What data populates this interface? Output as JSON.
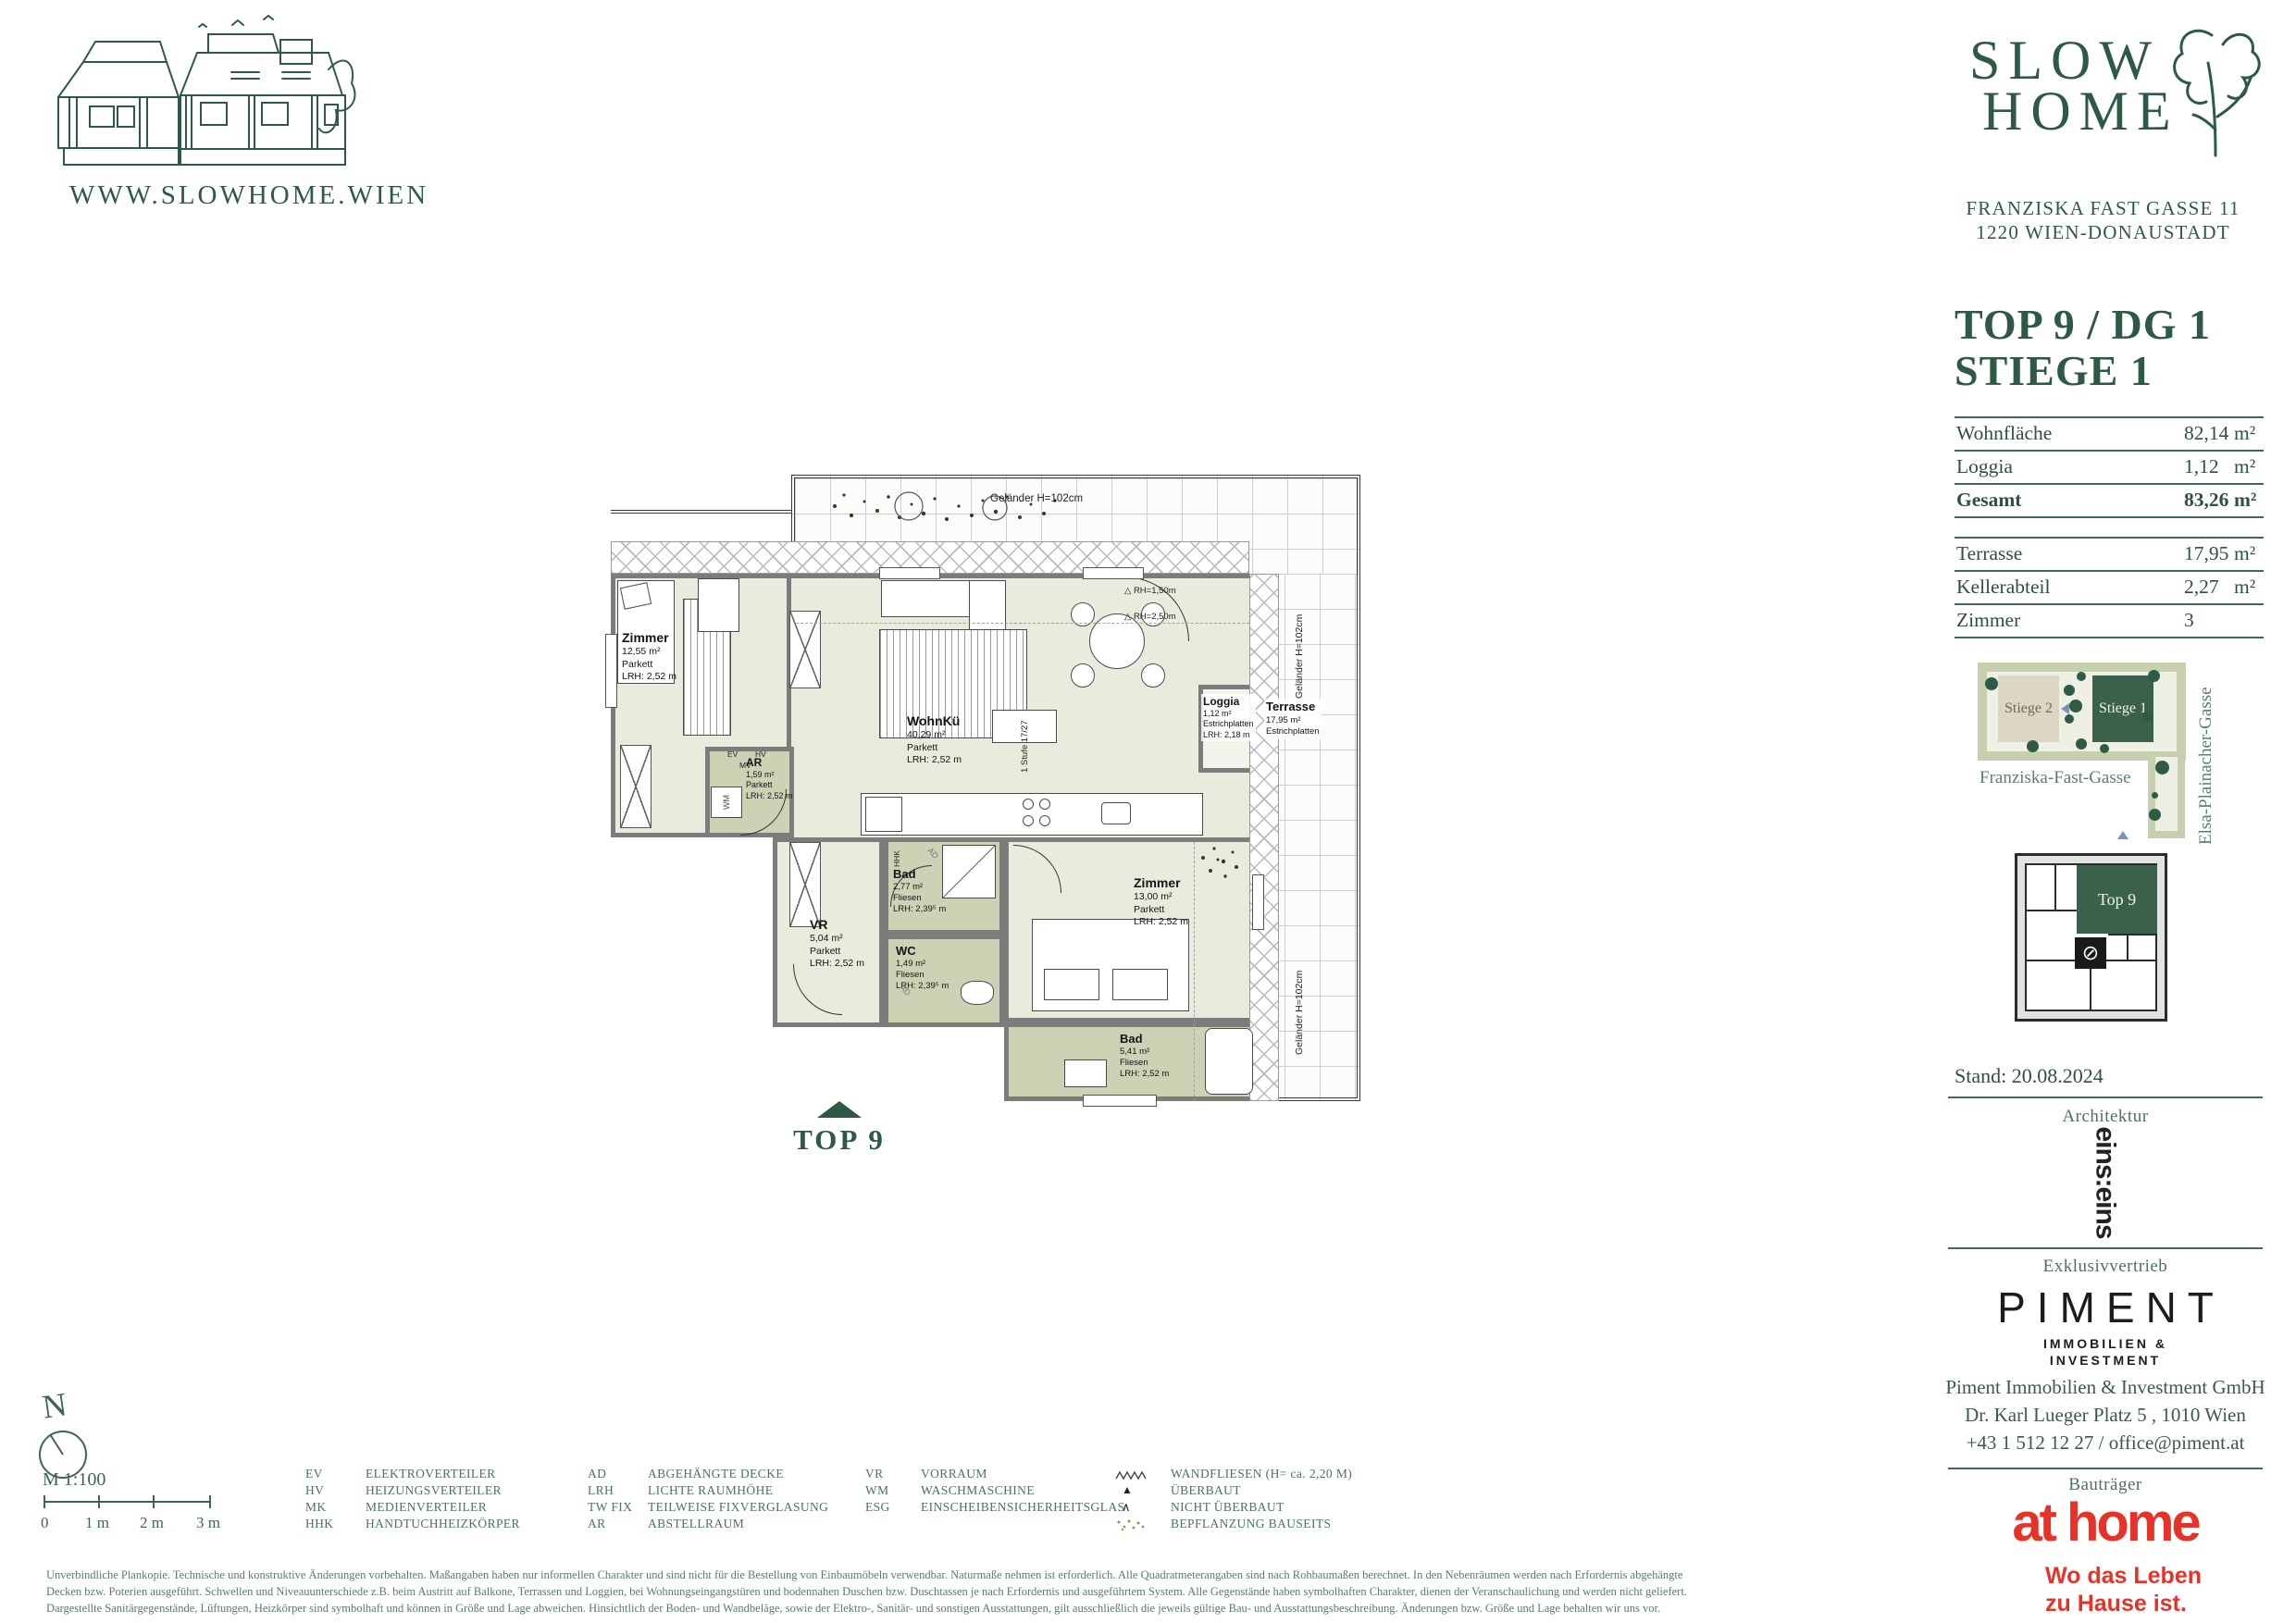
{
  "brand": {
    "website": "WWW.SLOWHOME.WIEN",
    "name_line1": "SLOW",
    "name_line2": "HOME",
    "address_line1": "FRANZISKA FAST GASSE 11",
    "address_line2": "1220 WIEN-DONAUSTADT"
  },
  "unit": {
    "title_line1": "TOP 9 / DG 1",
    "title_line2": "STIEGE 1",
    "areas": [
      {
        "label": "Wohnfläche",
        "value": "82,14",
        "unit": "m²"
      },
      {
        "label": "Loggia",
        "value": "1,12",
        "unit": "m²"
      },
      {
        "label": "Gesamt",
        "value": "83,26",
        "unit": "m²"
      }
    ],
    "extras": [
      {
        "label": "Terrasse",
        "value": "17,95",
        "unit": "m²"
      },
      {
        "label": "Kellerabteil",
        "value": "2,27",
        "unit": "m²"
      },
      {
        "label": "Zimmer",
        "value": "3",
        "unit": ""
      }
    ]
  },
  "site_plan": {
    "stiege2": "Stiege 2",
    "stiege1": "Stiege 1",
    "street_bottom": "Franziska-Fast-Gasse",
    "street_right": "Elsa-Plainacher-Gasse"
  },
  "key_plan": {
    "unit_label": "Top 9"
  },
  "floor_plan": {
    "rooms": {
      "zimmer1": {
        "name": "Zimmer",
        "area": "12,55 m²",
        "floor": "Parkett",
        "lrh": "LRH: 2,52 m"
      },
      "wohnkue": {
        "name": "WohnKü",
        "area": "40,29 m²",
        "floor": "Parkett",
        "lrh": "LRH: 2,52 m"
      },
      "ar": {
        "name": "AR",
        "area": "1,59 m²",
        "floor": "Parkett",
        "lrh": "LRH: 2,52 m"
      },
      "bad1": {
        "name": "Bad",
        "area": "2,77 m²",
        "floor": "Fliesen",
        "lrh": "LRH: 2,39⁵ m"
      },
      "wc": {
        "name": "WC",
        "area": "1,49 m²",
        "floor": "Fliesen",
        "lrh": "LRH: 2,39⁵ m"
      },
      "vr": {
        "name": "VR",
        "area": "5,04 m²",
        "floor": "Parkett",
        "lrh": "LRH: 2,52 m"
      },
      "zimmer2": {
        "name": "Zimmer",
        "area": "13,00 m²",
        "floor": "Parkett",
        "lrh": "LRH: 2,52 m"
      },
      "bad2": {
        "name": "Bad",
        "area": "5,41 m²",
        "floor": "Fliesen",
        "lrh": "LRH: 2,52 m"
      },
      "loggia": {
        "name": "Loggia",
        "area": "1,12 m²",
        "floor": "Estrichplatten",
        "lrh": "LRH: 2,18 m"
      },
      "terrasse": {
        "name": "Terrasse",
        "area": "17,95 m²",
        "floor": "Estrichplatten"
      }
    },
    "annotations": {
      "gelaender_top": "Geländer H=102cm",
      "gelaender_right_upper": "Geländer H=102cm",
      "gelaender_right_lower": "Geländer H=102cm",
      "rh_150": "△ RH=1,50m",
      "rh_250": "△ RH=2,50m",
      "stufe": "1 Stufe 17/27",
      "ev": "EV",
      "hv": "HV",
      "mv": "MV",
      "wm": "WM",
      "hhk": "HHK",
      "ad": "AD",
      "marker": "TOP 9"
    }
  },
  "scale": {
    "north": "N",
    "ratio": "M 1:100",
    "ticks": [
      "0",
      "1 m",
      "2 m",
      "3 m"
    ]
  },
  "legend": {
    "col1": [
      {
        "abbr": "EV",
        "name": "ELEKTROVERTEILER"
      },
      {
        "abbr": "HV",
        "name": "HEIZUNGSVERTEILER"
      },
      {
        "abbr": "MK",
        "name": "MEDIENVERTEILER"
      },
      {
        "abbr": "HHK",
        "name": "HANDTUCHHEIZKÖRPER"
      }
    ],
    "col2": [
      {
        "abbr": "AD",
        "name": "ABGEHÄNGTE DECKE"
      },
      {
        "abbr": "LRH",
        "name": "LICHTE RAUMHÖHE"
      },
      {
        "abbr": "TW FIX",
        "name": "TEILWEISE FIXVERGLASUNG"
      },
      {
        "abbr": "AR",
        "name": "ABSTELLRAUM"
      }
    ],
    "col3": [
      {
        "abbr": "VR",
        "name": "VORRAUM"
      },
      {
        "abbr": "WM",
        "name": "WASCHMASCHINE"
      },
      {
        "abbr": "ESG",
        "name": "EINSCHEIBENSICHERHEITSGLAS"
      }
    ],
    "col4": [
      {
        "name": "WANDFLIESEN (H= ca. 2,20 M)"
      },
      {
        "name": "ÜBERBAUT"
      },
      {
        "name": "NICHT ÜBERBAUT"
      },
      {
        "name": "BEPFLANZUNG BAUSEITS"
      }
    ]
  },
  "sections": {
    "stand": "Stand: 20.08.2024",
    "architektur": "Architektur",
    "architect_logo": "eins:eins",
    "exklusiv": "Exklusivvertrieb",
    "piment": "PIMENT",
    "piment_sub1": "IMMOBILIEN &",
    "piment_sub2": "INVESTMENT",
    "company": "Piment Immobilien & Investment GmbH",
    "company_address": "Dr. Karl Lueger Platz 5 , 1010 Wien",
    "company_contact": "+43 1 512 12 27 / office@piment.at",
    "bautraeger": "Bauträger",
    "athome": "at home",
    "tagline1": "Wo das Leben",
    "tagline2": "zu Hause ist."
  },
  "disclaimer": [
    "Unverbindliche Plankopie. Technische und konstruktive Änderungen vorbehalten. Maßangaben haben nur informellen Charakter und sind nicht für die Bestellung von Einbaumöbeln verwendbar. Naturmaße nehmen ist erforderlich. Alle Quadratmeterangaben sind nach Rohbaumaßen berechnet. In den Nebenräumen werden nach Erfordernis abgehängte",
    "Decken bzw. Poterien ausgeführt. Schwellen und Niveauunterschiede z.B. beim Austritt auf Balkone, Terrassen und Loggien, bei Wohnungseingangstüren und bodennahen Duschen bzw. Duschtassen je nach Erfordernis und ausgeführtem System. Alle Gegenstände haben symbolhaften Charakter, dienen der Veranschaulichung und werden nicht geliefert.",
    "Dargestellte Sanitärgegenstände, Lüftungen, Heizkörper sind symbolhaft und können in Größe und Lage abweichen. Hinsichtlich der Boden- und Wandbeläge, sowie der Elektro-, Sanitär- und sonstigen Ausstattungen, gilt ausschließlich die jeweils gültige Bau- und Ausstattungsbeschreibung. Änderungen bzw. Größe und Lage behalten wir uns vor."
  ]
}
